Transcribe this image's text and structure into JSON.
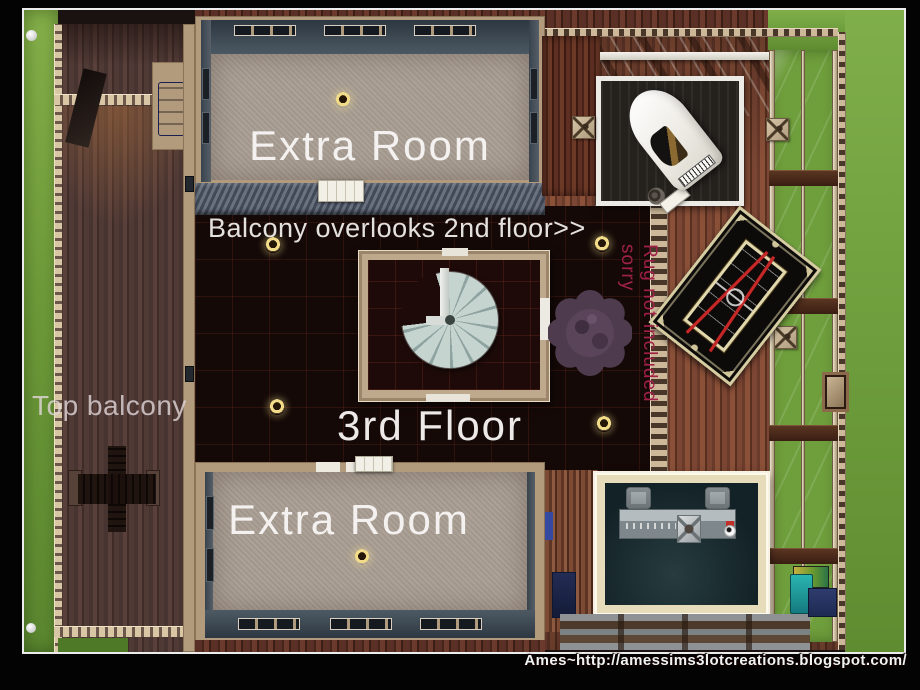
{
  "scene": {
    "game": "The Sims 3 lot screenshot",
    "view": "top-down floorplan",
    "floor_shown": "3rd Floor"
  },
  "annotations": {
    "extra_room_top": "Extra Room",
    "balcony_note": "Balcony overlooks 2nd floor>>",
    "floor_label": "3rd Floor",
    "extra_room_bottom": "Extra Room",
    "top_balcony": "Top balcony",
    "rug_disclaimer": "Rug not included sorry",
    "watermark": "Ames~http://amessims3lotcreations.blogspot.com/"
  },
  "colors": {
    "frame_black": "#030303",
    "inner_border_white": "#ececec",
    "grass": "#6f9c3a",
    "balcony_deck": "#4b3431",
    "carpet": "#a89d92",
    "room_wall_slate": "#3e4a53",
    "dark_floor": "#140907",
    "trim_tan": "#cdb999",
    "wood_floor": "#7b4634",
    "bar_wall_cream": "#e6dcba",
    "bar_floor_teal": "#162a2e",
    "rug_note_red": "#a02048",
    "lamp_yellow": "#f2dc8a",
    "stair_gray": "#c6d4d0"
  }
}
